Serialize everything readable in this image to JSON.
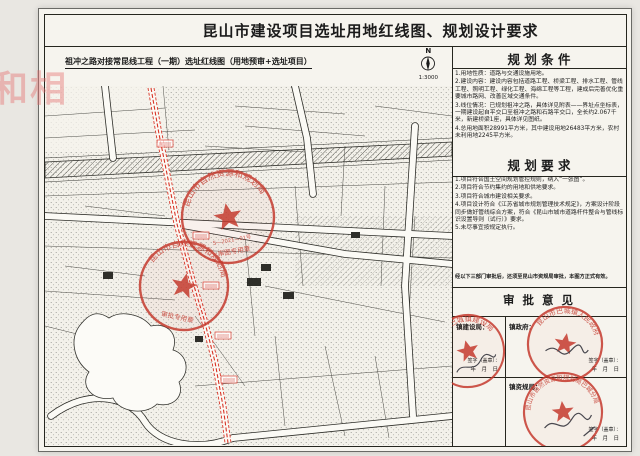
{
  "doc": {
    "title": "昆山市建设项目选址用地红线图、规划设计要求",
    "watermark": "和相"
  },
  "map": {
    "title": "祖冲之路对接常昆线工程（一期）选址红线图（用地预审+选址项目）",
    "north_label": "N",
    "scale": "1:3000",
    "stamps": {
      "upper": {
        "arc": "昆山市自然资源和规划局",
        "line": "S—2021—01号",
        "bottom": "审图专用章"
      },
      "lower": {
        "arc": "昆山市自然资源和规划局",
        "bottom": "审批专用章"
      }
    }
  },
  "conditions": {
    "header": "规 划 条 件",
    "items": [
      "1.用地性质：道路与交通设施用地。",
      "2.建设内容：建设内容包括道路工程、桥梁工程、排水工程、管线工程、照明工程、绿化工程、海绵工程等工程，建成后完善优化重要城市路网、改善区域交通条件。",
      "3.线位情况：已规划祖冲之路，具体详见附表——界址点坐标表，一期建设起自平交口至祖冲之路和石路平交口，全长约2.067千米，新建桥梁1座，具体详见图纸。",
      "4.总用地面积28991平方米，其中建设用地26483平方米，农村未利用地2245平方米。"
    ]
  },
  "requirements": {
    "header": "规 划 要 求",
    "items": [
      "1.项目符合国土空间规划管控规则，纳入“一张图”。",
      "2.项目符合节约集约的用地和供地要求。",
      "3.项目符合城市建设相关要求。",
      "4.项目设计符合《江苏省城市规划管理技术规定》，方案设计阶段同步做好管线综合方案，符合《昆山市城市道路杆件整合与管线标识设置导则（试行）》要求。",
      "5.未尽事宜按规定执行。"
    ]
  },
  "note": "经以下三部门审批后，还须至昆山市资规局审批，本图方正式有效。",
  "approval": {
    "header": "审 批 意 见",
    "cells": {
      "c1": {
        "label": "镇建设局：",
        "sign": "签字（盖章）：",
        "date": "年　月　日",
        "stamp_arc": "昆山市巴城镇建设局"
      },
      "c2": {
        "label": "镇政府：",
        "sign": "签字（盖章）：",
        "date": "年　月　日",
        "stamp_arc": "昆山市巴城镇人民政府"
      },
      "c3": {
        "label": "镇资规局：",
        "sign": "签字（盖章）：",
        "date": "年　月　日",
        "stamp_arc": "昆山市自然资源和规划局巴城分局"
      }
    }
  },
  "colors": {
    "stamp_red": "#c53a2e",
    "route_red": "#d42314"
  }
}
